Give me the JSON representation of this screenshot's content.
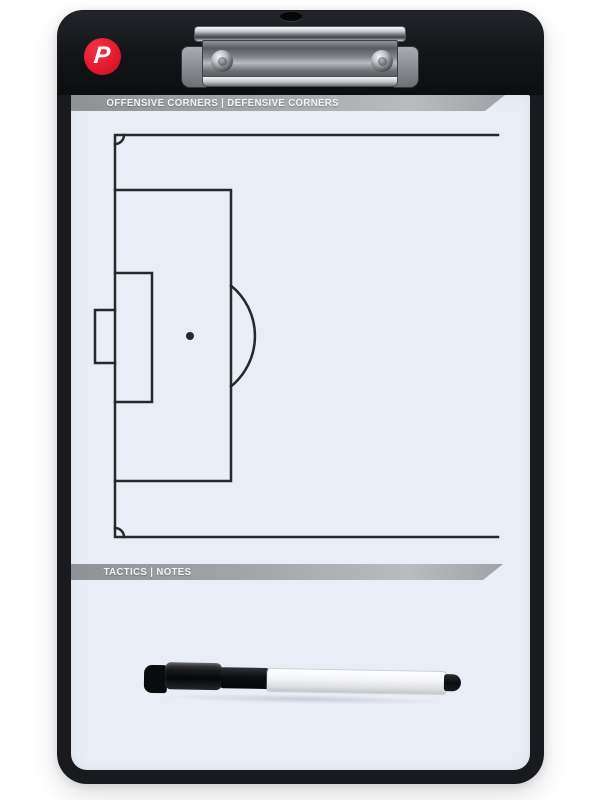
{
  "board": {
    "logo_letter": "P",
    "top_band_label": "OFFENSIVE CORNERS | DEFENSIVE CORNERS",
    "bottom_band_label": "TACTICS | NOTES"
  },
  "colors": {
    "background": "#ffffff",
    "frame_black": "#181a1e",
    "header_black": "#111316",
    "surface_white": "#e9eef6",
    "band_gray": "#9b9fa2",
    "band_text": "#f4f5f6",
    "logo_red": "#e51a2e",
    "pitch_line": "#26282a",
    "pen_black": "#0c0d10",
    "pen_white": "#f4f5f7"
  }
}
